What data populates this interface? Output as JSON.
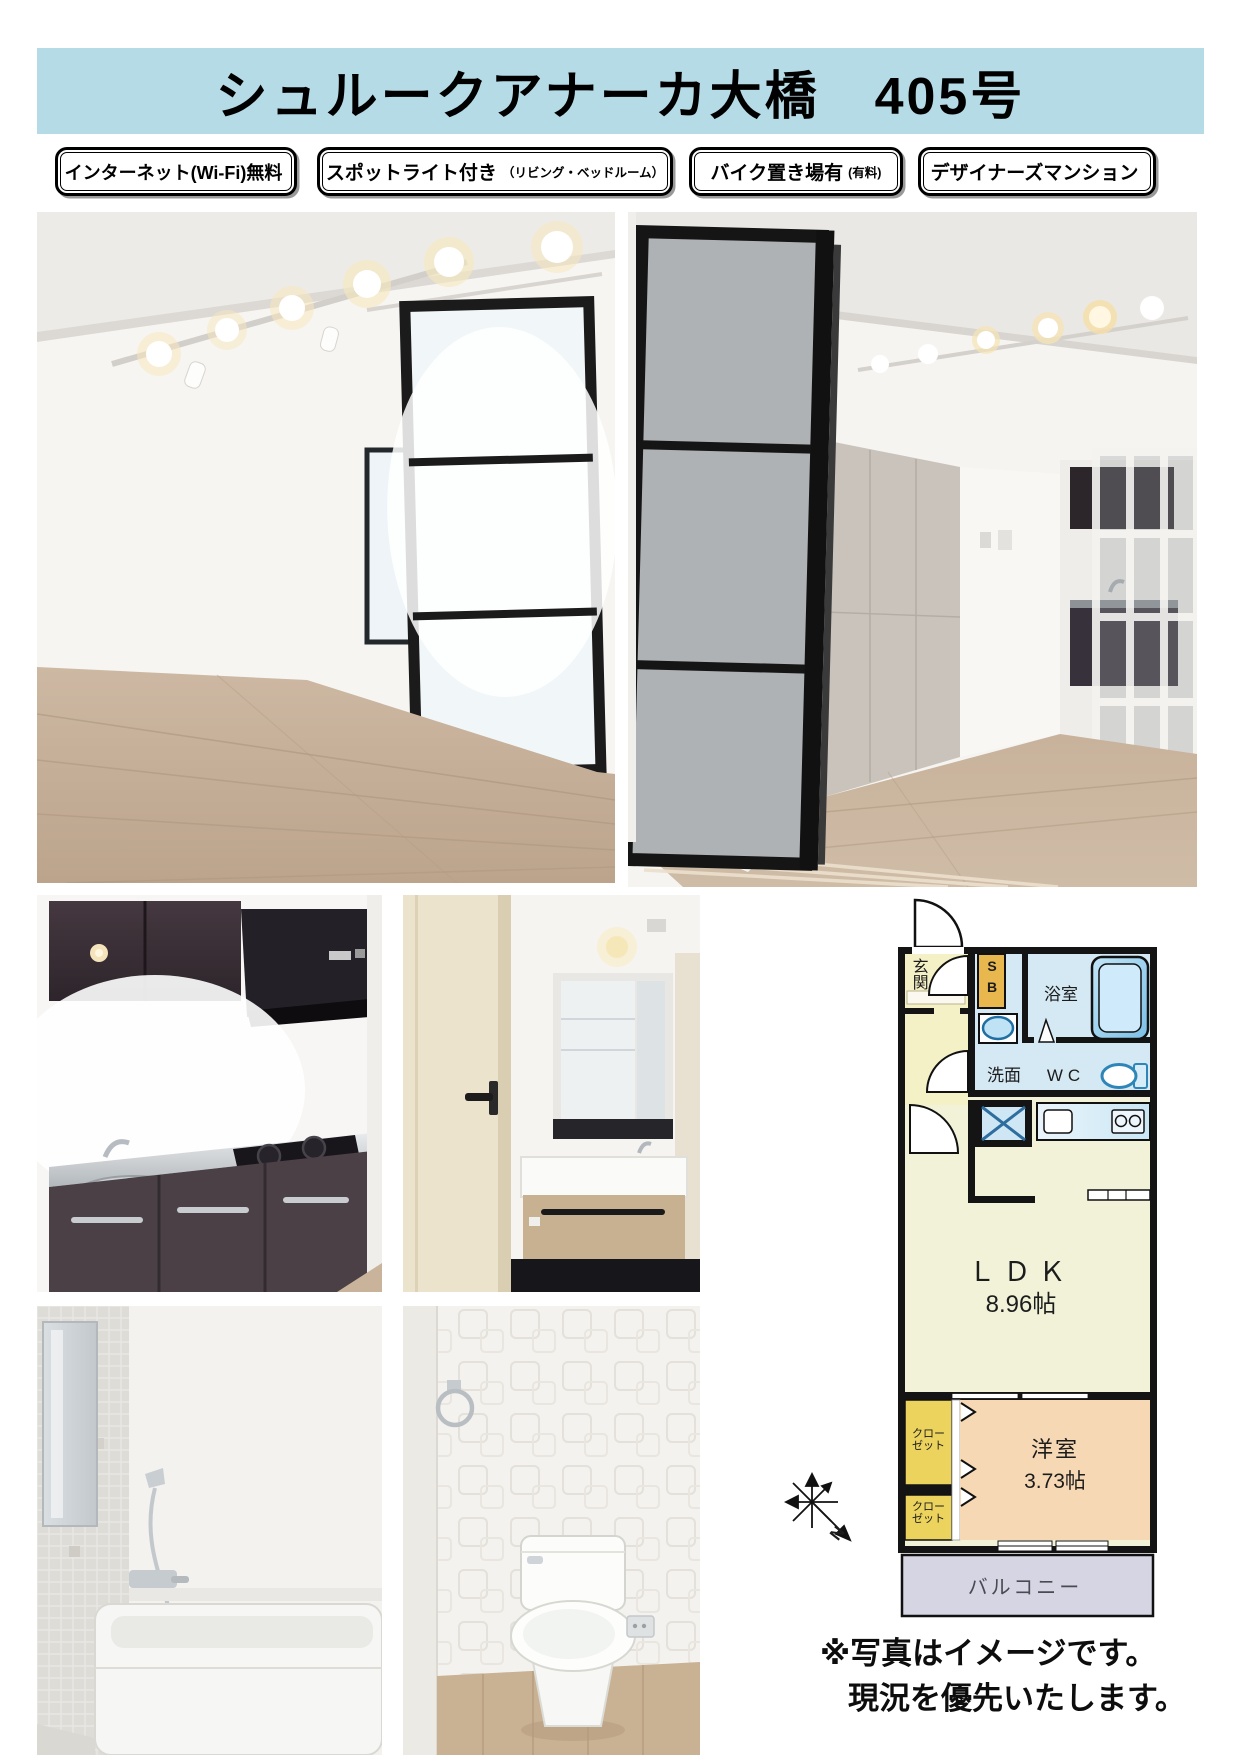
{
  "title": "シュルークアナーカ大橋　405号",
  "badges": [
    {
      "main": "インターネット(Wi-Fi)無料",
      "sub": ""
    },
    {
      "main": "スポットライト付き",
      "sub": "（リビング・ベッドルーム）"
    },
    {
      "main": "バイク置き場有",
      "sub": "(有料)"
    },
    {
      "main": "デザイナーズマンション",
      "sub": ""
    }
  ],
  "floor_plan": {
    "entrance": "玄関",
    "sb_line1": "S",
    "sb_line2": "B",
    "bathroom": "浴室",
    "washroom": "洗面",
    "wc": "WC",
    "ldk": "ＬＤＫ",
    "ldk_size": "8.96帖",
    "closet_line1": "クロー",
    "closet_line2": "ゼット",
    "bedroom": "洋室",
    "bedroom_size": "3.73帖",
    "balcony": "バルコニー",
    "compass_north": "N",
    "colors": {
      "wall": "#141414",
      "ldk": "#f2f2d9",
      "wet_area": "#d4e9f4",
      "entrance_hall": "#f5f1c6",
      "shoe_box": "#e8b84e",
      "closet": "#ecd35e",
      "bedroom": "#f6d9b4",
      "balcony": "#d5d5e3",
      "header_bar": "#b5dbe6"
    }
  },
  "notes": {
    "line1": "※写真はイメージです。",
    "line2": "現況を優先いたします。"
  }
}
